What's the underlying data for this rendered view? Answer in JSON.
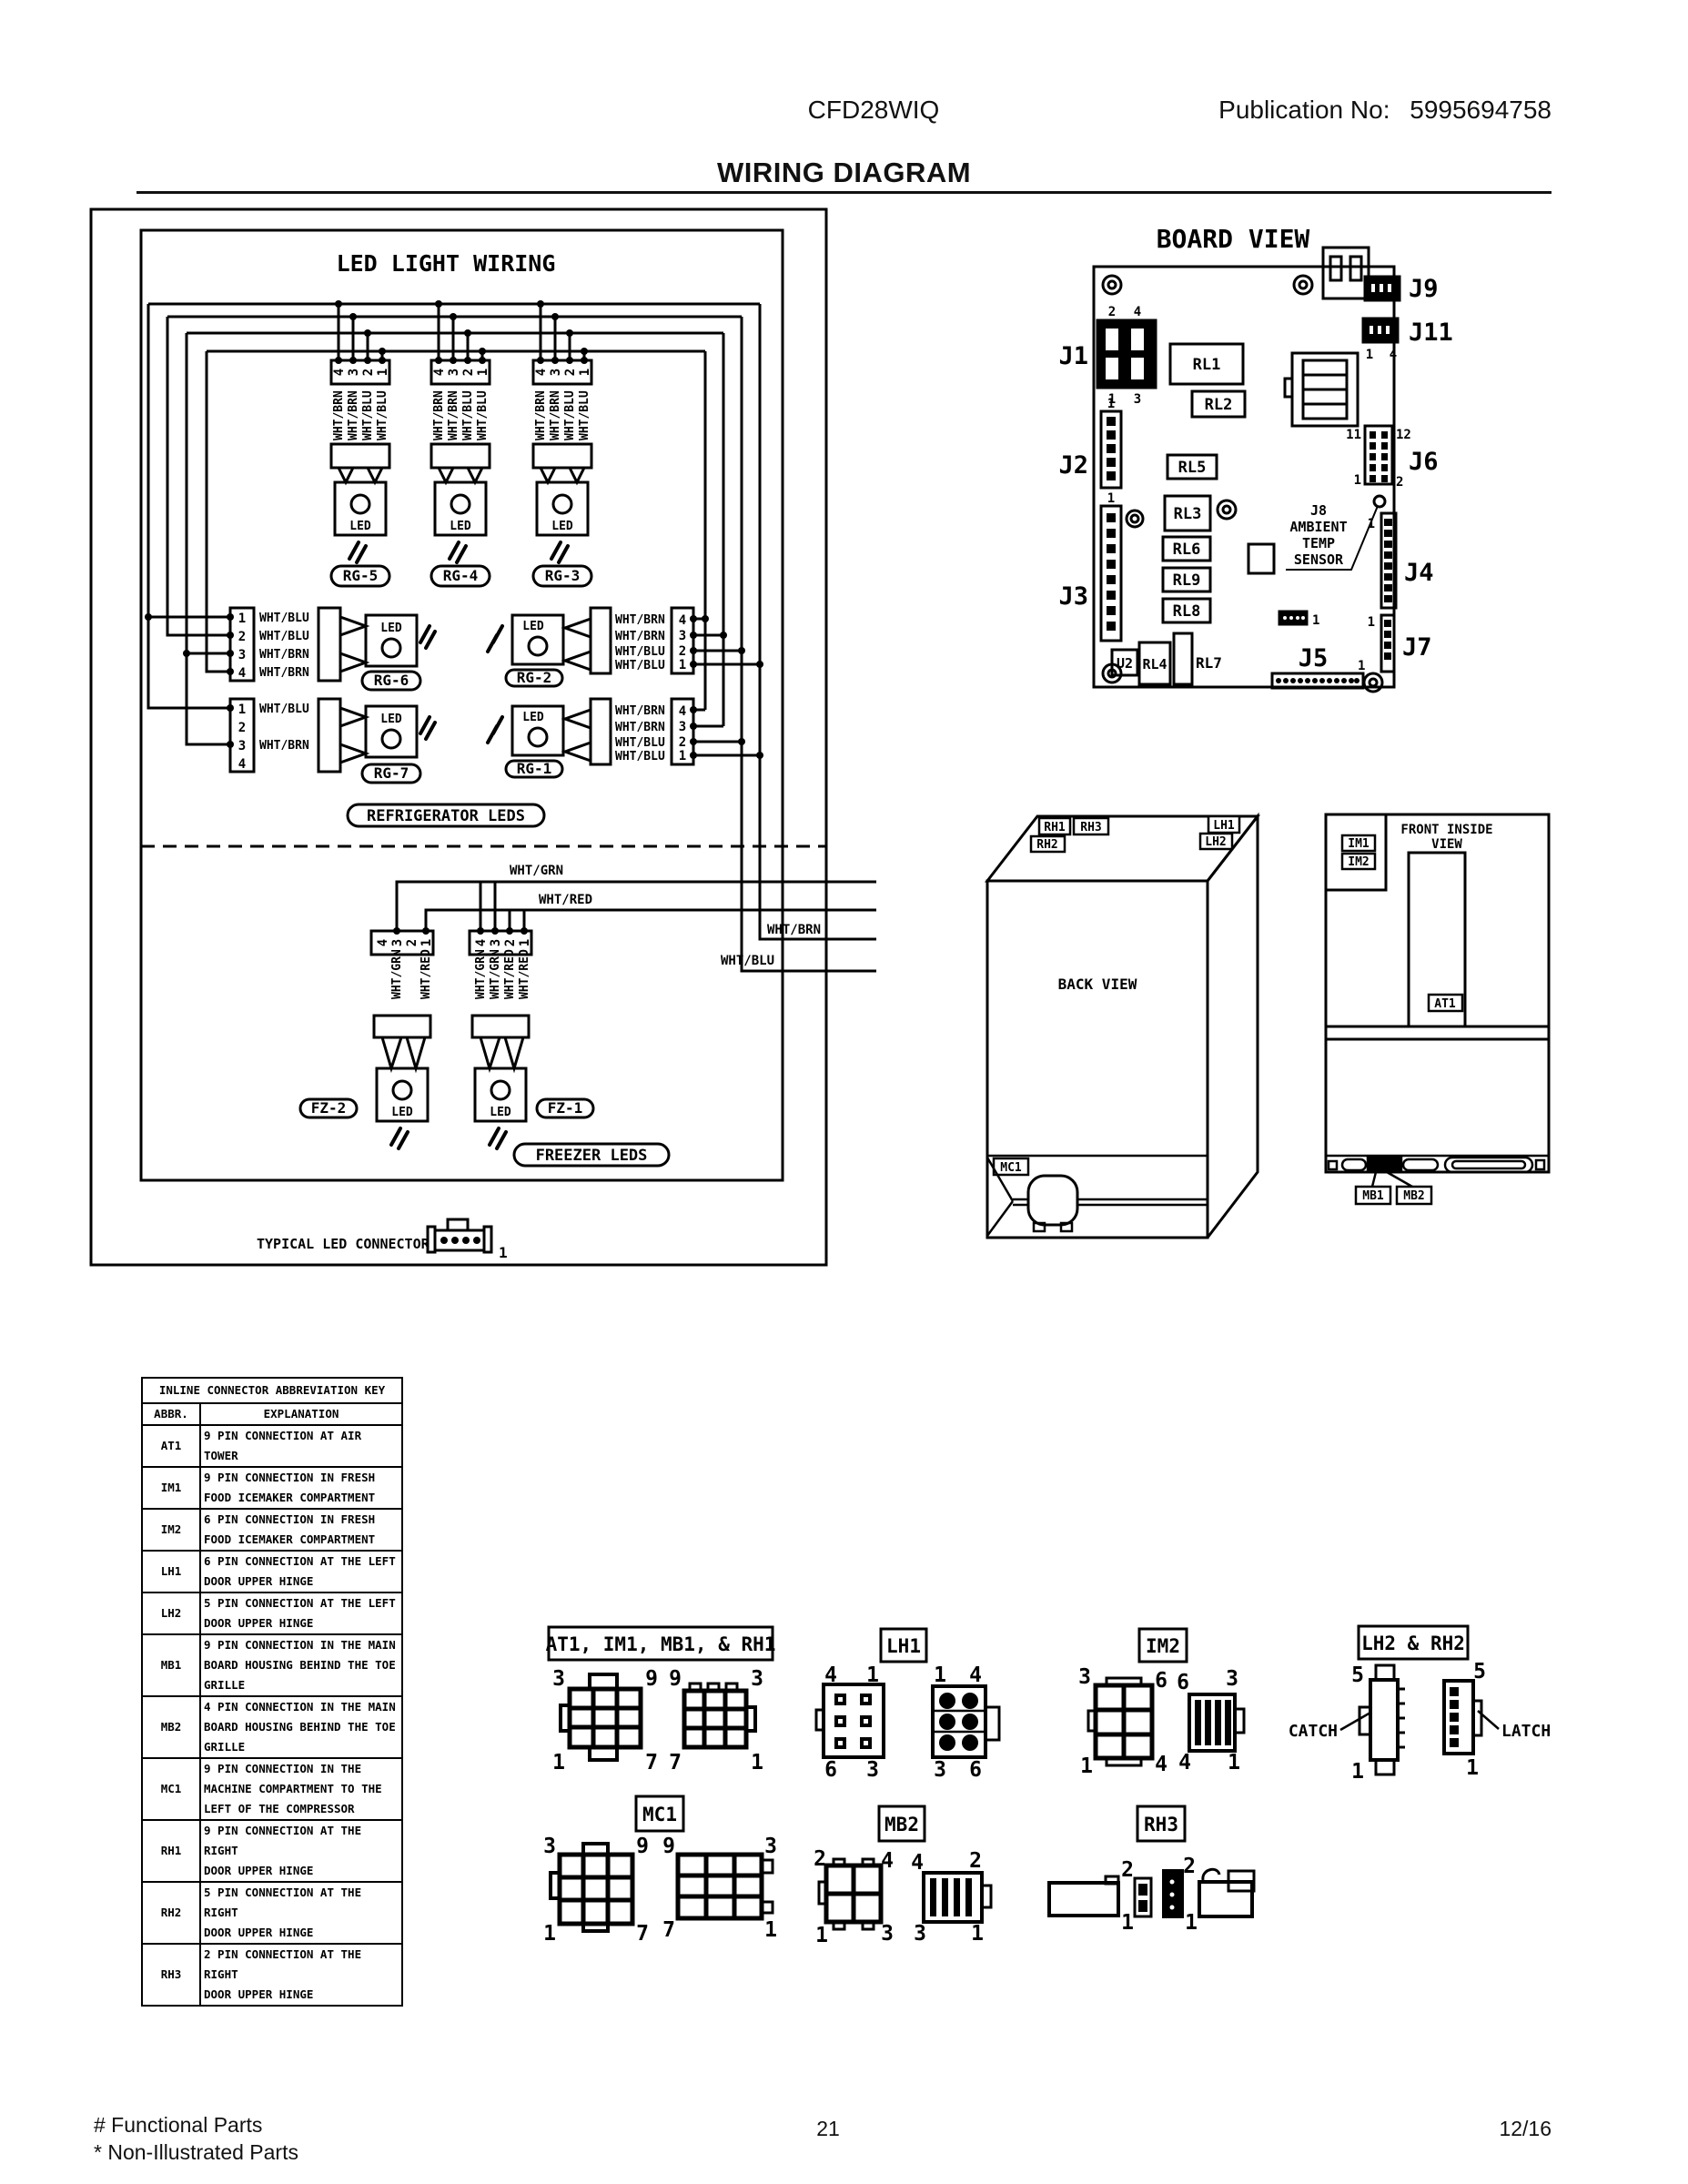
{
  "header": {
    "model": "CFD28WIQ",
    "pub_label": "Publication No:",
    "pub_no": "5995694758",
    "title": "WIRING DIAGRAM"
  },
  "led": {
    "title": "LED LIGHT WIRING",
    "led": "LED",
    "top_pins": [
      "4",
      "3",
      "2",
      "1"
    ],
    "top_wires": [
      "WHT/BRN",
      "WHT/BRN",
      "WHT/BLU",
      "WHT/BLU"
    ],
    "rg5": "RG-5",
    "rg4": "RG-4",
    "rg3": "RG-3",
    "rg6": {
      "name": "RG-6",
      "pins": [
        "1",
        "2",
        "3",
        "4"
      ],
      "wires": [
        "WHT/BLU",
        "WHT/BLU",
        "WHT/BRN",
        "WHT/BRN"
      ]
    },
    "rg7": {
      "name": "RG-7",
      "pins": [
        "1",
        "2",
        "3",
        "4"
      ],
      "wire1": "WHT/BLU",
      "wire3": "WHT/BRN"
    },
    "rg2": {
      "name": "RG-2"
    },
    "rg1": {
      "name": "RG-1"
    },
    "side_pins": [
      "4",
      "3",
      "2",
      "1"
    ],
    "side_wires": [
      "WHT/BRN",
      "WHT/BRN",
      "WHT/BLU",
      "WHT/BLU"
    ],
    "refrigerator": "REFRIGERATOR LEDS",
    "freezer": "FREEZER LEDS",
    "fz2": {
      "name": "FZ-2",
      "pins": [
        "4",
        "3",
        "2",
        "1"
      ],
      "wire3": "WHT/GRN",
      "wire1": "WHT/RED"
    },
    "fz1": {
      "name": "FZ-1",
      "pins": [
        "4",
        "3",
        "2",
        "1"
      ],
      "wires": [
        "WHT/GRN",
        "WHT/GRN",
        "WHT/RED",
        "WHT/RED"
      ]
    },
    "w_grn": "WHT/GRN",
    "w_red": "WHT/RED",
    "w_brn": "WHT/BRN",
    "w_blu": "WHT/BLU",
    "typical": "TYPICAL LED CONNECTOR",
    "one": "1"
  },
  "board": {
    "title": "BOARD VIEW",
    "j1": "J1",
    "j2": "J2",
    "j3": "J3",
    "j4": "J4",
    "j5": "J5",
    "j6": "J6",
    "j7": "J7",
    "j9": "J9",
    "j11": "J11",
    "rl1": "RL1",
    "rl2": "RL2",
    "rl3": "RL3",
    "rl4": "RL4",
    "rl5": "RL5",
    "rl6": "RL6",
    "rl7": "RL7",
    "rl8": "RL8",
    "rl9": "RL9",
    "u2": "U2",
    "j8": [
      "J8",
      "AMBIENT",
      "TEMP",
      "SENSOR"
    ],
    "n1": "1",
    "n2": "2",
    "n3": "3",
    "n4": "4",
    "n11": "11",
    "n12": "12"
  },
  "back": {
    "title": "BACK VIEW",
    "rh1": "RH1",
    "rh2": "RH2",
    "rh3": "RH3",
    "lh1": "LH1",
    "lh2": "LH2",
    "mc1": "MC1"
  },
  "front": {
    "line1": "FRONT INSIDE",
    "line2": "VIEW",
    "im1": "IM1",
    "im2": "IM2",
    "at1": "AT1",
    "mb1": "MB1",
    "mb2": "MB2"
  },
  "abbr_table": {
    "title": "INLINE CONNECTOR ABBREVIATION KEY",
    "col_abbr": "ABBR.",
    "col_exp": "EXPLANATION",
    "rows": [
      {
        "abbr": "AT1",
        "lines": [
          "9 PIN CONNECTION AT AIR TOWER"
        ]
      },
      {
        "abbr": "IM1",
        "lines": [
          "9 PIN CONNECTION IN FRESH",
          "FOOD ICEMAKER COMPARTMENT"
        ]
      },
      {
        "abbr": "IM2",
        "lines": [
          "6 PIN CONNECTION IN FRESH",
          "FOOD ICEMAKER COMPARTMENT"
        ]
      },
      {
        "abbr": "LH1",
        "lines": [
          "6 PIN CONNECTION AT THE LEFT",
          "DOOR UPPER HINGE"
        ]
      },
      {
        "abbr": "LH2",
        "lines": [
          "5 PIN CONNECTION AT THE LEFT",
          "DOOR UPPER HINGE"
        ]
      },
      {
        "abbr": "MB1",
        "lines": [
          "9 PIN CONNECTION IN THE MAIN",
          "BOARD HOUSING BEHIND THE TOE",
          "GRILLE"
        ]
      },
      {
        "abbr": "MB2",
        "lines": [
          "4 PIN CONNECTION IN THE MAIN",
          "BOARD HOUSING BEHIND THE TOE",
          "GRILLE"
        ]
      },
      {
        "abbr": "MC1",
        "lines": [
          "9 PIN CONNECTION IN THE",
          "MACHINE COMPARTMENT TO THE",
          "LEFT OF THE COMPRESSOR"
        ]
      },
      {
        "abbr": "RH1",
        "lines": [
          "9 PIN CONNECTION AT THE RIGHT",
          "DOOR UPPER HINGE"
        ]
      },
      {
        "abbr": "RH2",
        "lines": [
          "5 PIN CONNECTION AT THE RIGHT",
          "DOOR UPPER HINGE"
        ]
      },
      {
        "abbr": "RH3",
        "lines": [
          "2 PIN CONNECTION AT THE RIGHT",
          "DOOR UPPER HINGE"
        ]
      }
    ]
  },
  "conn": {
    "g1": {
      "label": "AT1, IM1, MB1, & RH1",
      "left": [
        "3",
        "9",
        "1",
        "7"
      ],
      "right": [
        "9",
        "3",
        "7",
        "1"
      ]
    },
    "lh1": {
      "label": "LH1",
      "left": [
        "4",
        "1",
        "6",
        "3"
      ],
      "right": [
        "1",
        "4",
        "3",
        "6"
      ]
    },
    "im2": {
      "label": "IM2",
      "left": [
        "3",
        "6",
        "1",
        "4"
      ],
      "right": [
        "6",
        "3",
        "4",
        "1"
      ]
    },
    "lh2rh2": {
      "label": "LH2 & RH2",
      "catch": "CATCH",
      "latch": "LATCH",
      "left": [
        "5",
        "1"
      ],
      "right": [
        "5",
        "1"
      ]
    },
    "mc1": {
      "label": "MC1",
      "left": [
        "3",
        "9",
        "1",
        "7"
      ],
      "right": [
        "9",
        "3",
        "7",
        "1"
      ]
    },
    "mb2": {
      "label": "MB2",
      "left": [
        "2",
        "4",
        "1",
        "3"
      ],
      "right": [
        "4",
        "2",
        "3",
        "1"
      ]
    },
    "rh3": {
      "label": "RH3",
      "pins": [
        "2",
        "1",
        "2",
        "1"
      ]
    }
  },
  "footer": {
    "functional": "# Functional Parts",
    "non_illustrated": "* Non-Illustrated Parts",
    "page": "21",
    "date": "12/16"
  }
}
